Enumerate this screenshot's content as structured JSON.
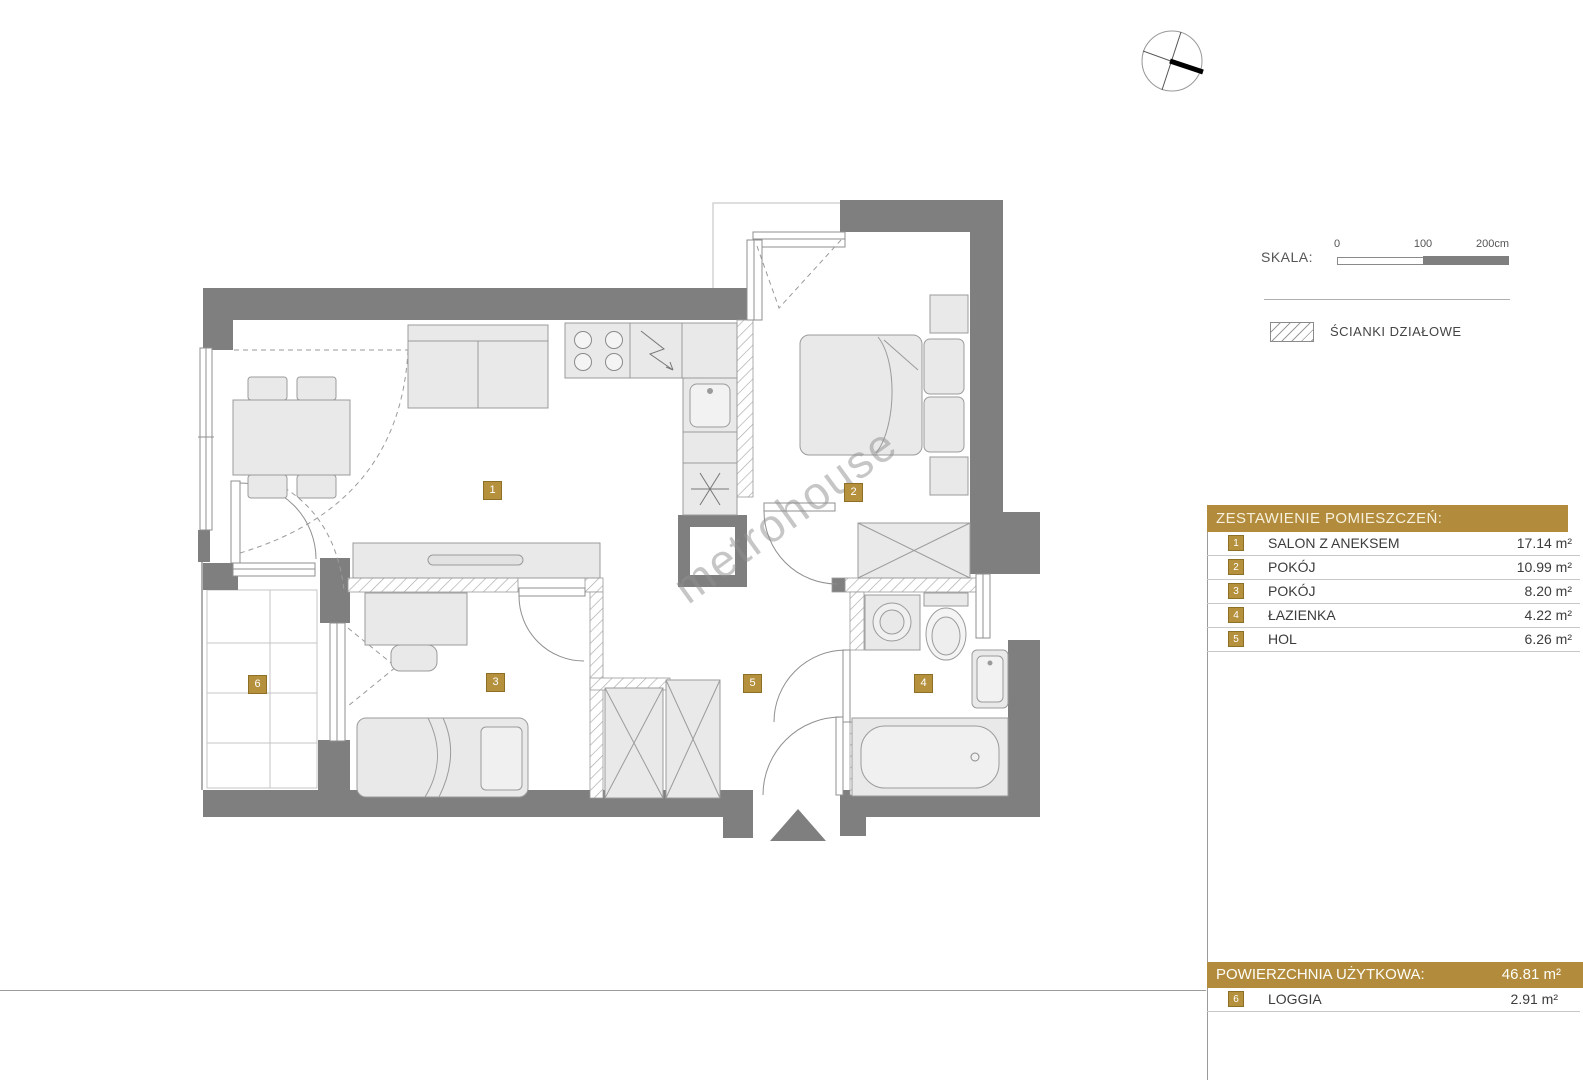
{
  "watermark": "metrohouse",
  "scale": {
    "label": "SKALA:",
    "tick0": "0",
    "tick1": "100",
    "tick2": "200cm"
  },
  "legend": {
    "partition_walls_label": "ŚCIANKI DZIAŁOWE"
  },
  "rooms_table": {
    "title": "ZESTAWIENIE POMIESZCZEŃ:",
    "rows": [
      {
        "number": "1",
        "name": "SALON Z ANEKSEM",
        "area": "17.14 m²"
      },
      {
        "number": "2",
        "name": "POKÓJ",
        "area": "10.99 m²"
      },
      {
        "number": "3",
        "name": "POKÓJ",
        "area": "8.20 m²"
      },
      {
        "number": "4",
        "name": "ŁAZIENKA",
        "area": "4.22 m²"
      },
      {
        "number": "5",
        "name": "HOL",
        "area": "6.26 m²"
      }
    ]
  },
  "summary": {
    "label": "POWIERZCHNIA UŻYTKOWA:",
    "value": "46.81 m²"
  },
  "loggia_row": {
    "number": "6",
    "name": "LOGGIA",
    "area": "2.91 m²"
  },
  "colors": {
    "accent_gold": "#b28c3c",
    "wall_gray": "#7f7f7f"
  }
}
